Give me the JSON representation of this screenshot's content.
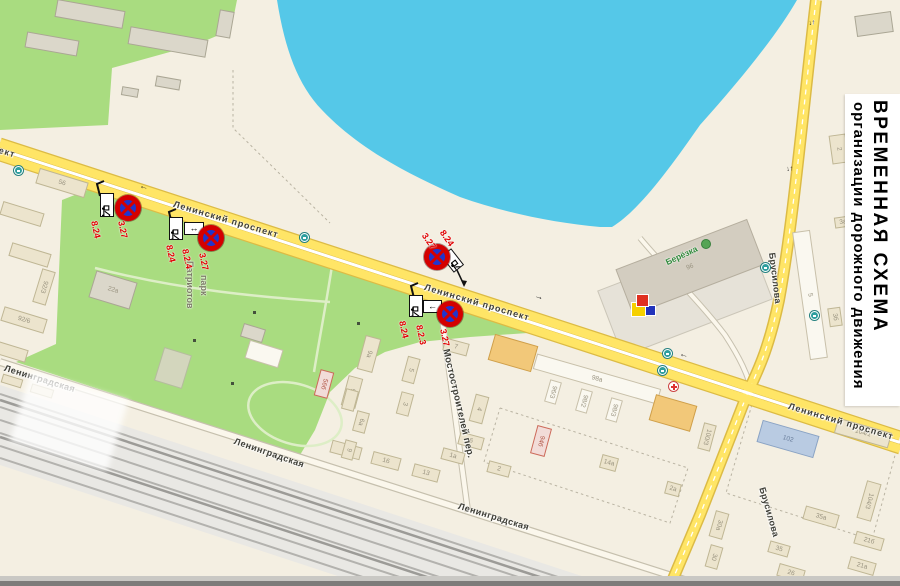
{
  "banner": {
    "line1": "ВРЕМЕННАЯ  СХЕМА",
    "line2": "организации дорожного движения"
  },
  "colors": {
    "bg": "#f4efe2",
    "lake": "#55c8e8",
    "park": "#a9dc80",
    "road_fill": "#ffe566",
    "road_casing": "#dcbb45",
    "white_road": "#fbf7ec",
    "white_road_casing": "#c6c0ae",
    "railway": "#e9e8e4",
    "track": "#b3b2ae",
    "sign_red": "#d40000",
    "sign_blue": "#2135cc",
    "label_red": "#e00000"
  },
  "map": {
    "street_labels": [
      {
        "t": "Ленинский проспект",
        "x": 175,
        "y": 199,
        "r": 16.5,
        "s": 9,
        "ls": 1
      },
      {
        "t": "Ленинский проспект",
        "x": 426,
        "y": 282,
        "r": 16.5,
        "s": 9,
        "ls": 1
      },
      {
        "t": "Ленинский проспект",
        "x": 790,
        "y": 401,
        "r": 16.5,
        "s": 9,
        "ls": 1
      },
      {
        "t": "проспект",
        "x": -30,
        "y": 136,
        "r": 16.5,
        "s": 9,
        "ls": 1
      },
      {
        "t": "Ленинградская",
        "x": 6,
        "y": 363,
        "r": 17,
        "s": 9,
        "ls": 0.5
      },
      {
        "t": "Ленинградская",
        "x": 236,
        "y": 436,
        "r": 19,
        "s": 9,
        "ls": 0.5
      },
      {
        "t": "Ленинградская",
        "x": 460,
        "y": 501,
        "r": 17,
        "s": 9,
        "ls": 0.5
      },
      {
        "t": "Мостостроителей пер.",
        "x": 451,
        "y": 348,
        "r": 77,
        "s": 9.5,
        "ls": 0.3
      },
      {
        "t": "Брусилова",
        "x": 777,
        "y": 252,
        "r": 83,
        "s": 9,
        "ls": 0.3
      },
      {
        "t": "Брусилова",
        "x": 767,
        "y": 486,
        "r": 74,
        "s": 9,
        "ls": 0.3
      }
    ],
    "poi_labels": [
      {
        "t": "Патриотов",
        "x": 195,
        "y": 261,
        "r": 90,
        "s": 9,
        "c": "#7c7c66"
      },
      {
        "t": "парк",
        "x": 209,
        "y": 275,
        "r": 90,
        "s": 9,
        "c": "#7c7c66"
      },
      {
        "t": "Берёзка",
        "x": 664,
        "y": 258,
        "r": -25,
        "s": 8.5,
        "c": "#318a3c"
      }
    ],
    "road_arrows": [
      {
        "t": "←",
        "x": 141,
        "y": 181,
        "r": 16.5,
        "s": 9
      },
      {
        "t": "→",
        "x": 536,
        "y": 291,
        "r": 16.5,
        "s": 9
      },
      {
        "t": "←",
        "x": 681,
        "y": 349,
        "r": 16.5,
        "s": 9
      },
      {
        "t": "↓↑",
        "x": 808,
        "y": 20,
        "r": -8,
        "s": 7
      },
      {
        "t": "↓↑",
        "x": 786,
        "y": 166,
        "r": -6,
        "s": 7
      }
    ],
    "buildings": [
      [
        90,
        14,
        68,
        17,
        10,
        "g",
        ""
      ],
      [
        168,
        42,
        78,
        17,
        10,
        "g",
        ""
      ],
      [
        52,
        44,
        52,
        15,
        10,
        "g",
        ""
      ],
      [
        225,
        24,
        14,
        26,
        10,
        "g",
        ""
      ],
      [
        168,
        83,
        24,
        10,
        10,
        "g",
        ""
      ],
      [
        130,
        92,
        16,
        8,
        10,
        "g",
        ""
      ],
      [
        62,
        183,
        50,
        15,
        17,
        "b",
        "56"
      ],
      [
        22,
        214,
        42,
        13,
        17,
        "b",
        ""
      ],
      [
        30,
        255,
        40,
        13,
        17,
        "b",
        ""
      ],
      [
        44,
        287,
        13,
        34,
        17,
        "b",
        "92/3"
      ],
      [
        24,
        320,
        44,
        14,
        17,
        "b",
        "92/6"
      ],
      [
        12,
        352,
        30,
        12,
        17,
        "b",
        ""
      ],
      [
        12,
        381,
        20,
        8,
        17,
        "b",
        ""
      ],
      [
        42,
        391,
        22,
        8,
        17,
        "b",
        ""
      ],
      [
        113,
        290,
        42,
        27,
        17,
        "g",
        "22а"
      ],
      [
        253,
        333,
        22,
        13,
        17,
        "g",
        ""
      ],
      [
        264,
        354,
        34,
        18,
        17,
        "w",
        ""
      ],
      [
        369,
        354,
        15,
        34,
        15,
        "b",
        "9а"
      ],
      [
        352,
        392,
        14,
        30,
        15,
        "b",
        "9в"
      ],
      [
        411,
        370,
        12,
        25,
        15,
        "b",
        "5"
      ],
      [
        405,
        404,
        12,
        22,
        15,
        "b",
        "3"
      ],
      [
        346,
        450,
        30,
        12,
        15,
        "b",
        "18"
      ],
      [
        386,
        461,
        28,
        12,
        15,
        "b",
        "16"
      ],
      [
        426,
        473,
        26,
        12,
        15,
        "b",
        "13"
      ],
      [
        456,
        347,
        24,
        12,
        15,
        "b",
        "7"
      ],
      [
        479,
        409,
        13,
        27,
        15,
        "b",
        "4"
      ],
      [
        471,
        441,
        24,
        12,
        15,
        "b",
        "6"
      ],
      [
        453,
        456,
        22,
        11,
        15,
        "b",
        "1а"
      ],
      [
        499,
        469,
        22,
        11,
        15,
        "b",
        "2"
      ],
      [
        324,
        384,
        13,
        26,
        15,
        "p",
        "56б"
      ],
      [
        350,
        400,
        12,
        20,
        15,
        "b",
        ""
      ],
      [
        361,
        422,
        12,
        20,
        15,
        "b",
        "6а"
      ],
      [
        349,
        450,
        11,
        18,
        15,
        "b",
        "9"
      ],
      [
        513,
        353,
        44,
        26,
        16,
        "o",
        ""
      ],
      [
        597,
        379,
        128,
        15,
        16,
        "w",
        "98а"
      ],
      [
        553,
        392,
        11,
        22,
        16,
        "w",
        "96/3"
      ],
      [
        584,
        401,
        11,
        22,
        16,
        "w",
        "98/2"
      ],
      [
        614,
        410,
        11,
        22,
        16,
        "w",
        "98/3"
      ],
      [
        673,
        413,
        42,
        26,
        16,
        "o",
        ""
      ],
      [
        541,
        441,
        14,
        28,
        15,
        "p",
        "94б"
      ],
      [
        609,
        463,
        16,
        13,
        15,
        "b",
        "14а"
      ],
      [
        707,
        437,
        12,
        26,
        15,
        "b",
        "100/3"
      ],
      [
        673,
        489,
        14,
        12,
        15,
        "b",
        "2а"
      ],
      [
        690,
        267,
        140,
        48,
        -21,
        "t",
        "96"
      ],
      [
        874,
        24,
        36,
        20,
        -8,
        "g",
        ""
      ],
      [
        839,
        149,
        16,
        28,
        -8,
        "b",
        "2"
      ],
      [
        843,
        222,
        16,
        10,
        -8,
        "b",
        "3а"
      ],
      [
        810,
        295,
        17,
        128,
        -8,
        "w",
        "5"
      ],
      [
        835,
        317,
        12,
        18,
        -8,
        "b",
        "3б"
      ],
      [
        788,
        439,
        58,
        22,
        16,
        "bl",
        "102"
      ],
      [
        863,
        433,
        55,
        15,
        16,
        "b",
        "104/1"
      ],
      [
        869,
        501,
        14,
        38,
        16,
        "b",
        "104/3"
      ],
      [
        821,
        517,
        34,
        13,
        16,
        "b",
        "35а"
      ],
      [
        869,
        541,
        28,
        12,
        16,
        "b",
        "21б"
      ],
      [
        862,
        566,
        26,
        12,
        16,
        "b",
        "21а"
      ],
      [
        719,
        525,
        13,
        26,
        16,
        "b",
        "30а"
      ],
      [
        714,
        557,
        12,
        22,
        16,
        "b",
        "30"
      ],
      [
        791,
        573,
        26,
        12,
        16,
        "b",
        "26"
      ],
      [
        779,
        549,
        20,
        11,
        16,
        "b",
        "35"
      ]
    ],
    "bus_stops": [
      [
        14,
        166
      ],
      [
        300,
        233
      ],
      [
        663,
        349
      ],
      [
        658,
        366
      ],
      [
        761,
        263
      ],
      [
        810,
        311
      ]
    ],
    "medical_cross": [
      668,
      381
    ],
    "tree_icon": [
      701,
      239
    ],
    "logo_squares": [
      {
        "x": 632,
        "y": 303,
        "s": 13,
        "c": "#f6d000"
      },
      {
        "x": 646,
        "y": 306,
        "s": 9,
        "c": "#2233bb"
      },
      {
        "x": 637,
        "y": 295,
        "s": 11,
        "c": "#e03020"
      }
    ],
    "park_dots": [
      [
        253,
        311
      ],
      [
        193,
        339
      ],
      [
        357,
        322
      ],
      [
        231,
        382
      ]
    ],
    "signs": {
      "groups": [
        {
          "pole": [
            [
              104,
              181
            ],
            [
              97,
              184
            ],
            [
              100,
              196
            ]
          ],
          "tow": {
            "x": 100,
            "y": 193,
            "w": 14,
            "h": 24,
            "r": 0
          },
          "arrow": null,
          "circle": {
            "cx": 128,
            "cy": 208
          },
          "labels": [
            {
              "t": "8.24",
              "x": 99,
              "y": 220,
              "r": 78
            },
            {
              "t": "3.27",
              "x": 126,
              "y": 220,
              "r": 78
            }
          ]
        },
        {
          "pole": [
            [
              176,
              209
            ],
            [
              169,
              212
            ],
            [
              172,
              224
            ]
          ],
          "tow": {
            "x": 169,
            "y": 217,
            "w": 14,
            "h": 23,
            "r": 0
          },
          "arrow": {
            "x": 184,
            "y": 222,
            "w": 20,
            "h": 13,
            "g": "↔"
          },
          "circle": {
            "cx": 211,
            "cy": 238
          },
          "labels": [
            {
              "t": "8.24",
              "x": 174,
              "y": 244,
              "r": 78
            },
            {
              "t": "8.2.4",
              "x": 190,
              "y": 248,
              "r": 78
            },
            {
              "t": "3.27",
              "x": 207,
              "y": 252,
              "r": 78
            }
          ]
        },
        {
          "pole": [
            [
              418,
              283
            ],
            [
              411,
              286
            ],
            [
              414,
              298
            ]
          ],
          "tow": {
            "x": 409,
            "y": 295,
            "w": 14,
            "h": 22,
            "r": 0
          },
          "arrow": {
            "x": 423,
            "y": 300,
            "w": 19,
            "h": 13,
            "g": "←"
          },
          "circle": {
            "cx": 450,
            "cy": 314
          },
          "labels": [
            {
              "t": "8.24",
              "x": 407,
              "y": 320,
              "r": 78
            },
            {
              "t": "8.2.3",
              "x": 424,
              "y": 324,
              "r": 78
            },
            {
              "t": "3.27",
              "x": 448,
              "y": 328,
              "r": 78
            }
          ]
        },
        {
          "pole": null,
          "tow": {
            "x": 446,
            "y": 250,
            "w": 13,
            "h": 21,
            "r": -38
          },
          "arrow": null,
          "circle": {
            "cx": 437,
            "cy": 257
          },
          "labels": [
            {
              "t": "3.27",
              "x": 428,
              "y": 231,
              "r": 55
            },
            {
              "t": "8.24",
              "x": 446,
              "y": 228,
              "r": 55
            }
          ],
          "leader": [
            [
              456,
              268
            ],
            [
              464,
              285
            ]
          ]
        }
      ]
    }
  }
}
